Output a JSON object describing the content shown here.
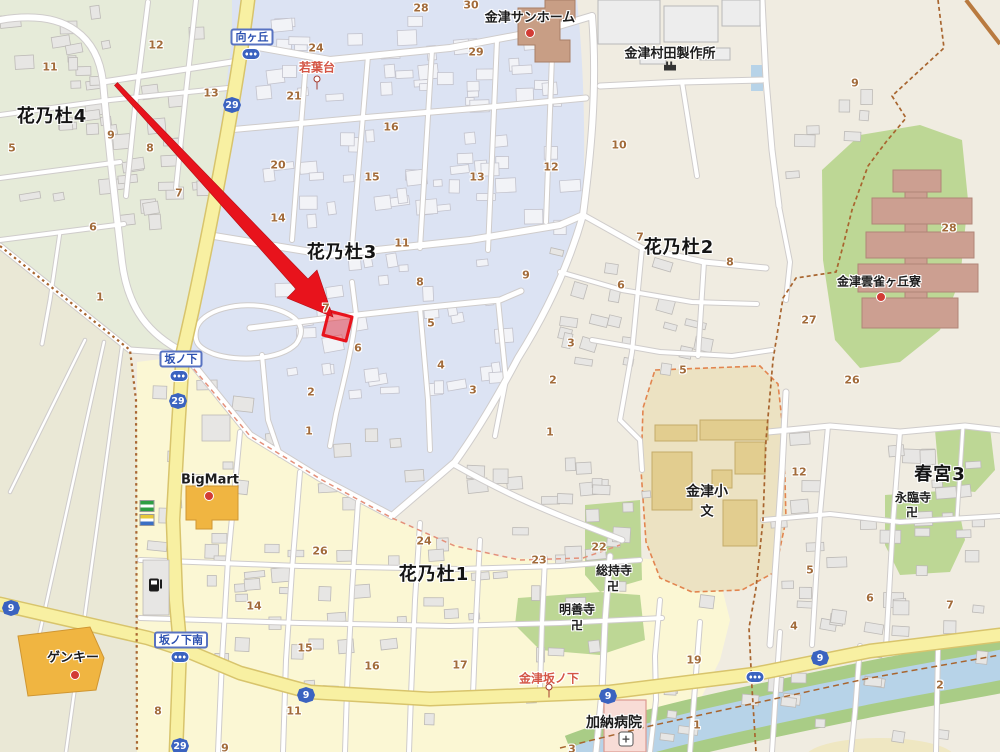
{
  "palette": {
    "base": "#f0ece1",
    "region_green": "#e6ebd9",
    "region_field": "#eae8d6",
    "region_blue": "#dce3f3",
    "region_yellow": "#fbf7d4",
    "green_patch": "#bdd795",
    "school_ground": "#ece2c2",
    "school_building": "#e2cd8f",
    "dorm_building": "#cc9f91",
    "special_brown": "#c89e85",
    "river": "#b7d3e8",
    "river_bank": "#a9cc86",
    "road_yellow": "#f8f0a2",
    "road_yellow_edge": "#d8c46c",
    "road_edge": "#cfcccb",
    "building_grey": "#e7e6e4",
    "building_blue_area": "#f2f3f7",
    "store_orange": "#f0b541",
    "hospital_pink": "#f8dcd6",
    "boundary_brown": "#a8652f",
    "boundary_orange": "#e2854f",
    "highlight_red": "#e8131c",
    "shield_blue": "#3b63c0",
    "number_brown": "#a26b3a",
    "poi_orange": "#d45545",
    "bus_blue": "#2b50b0"
  },
  "districts": [
    {
      "text": "花乃杜4",
      "x": 52,
      "y": 115
    },
    {
      "text": "花乃杜3",
      "x": 342,
      "y": 251
    },
    {
      "text": "花乃杜2",
      "x": 679,
      "y": 246
    },
    {
      "text": "花乃杜1",
      "x": 434,
      "y": 573
    },
    {
      "text": "春宮3",
      "x": 940,
      "y": 473
    }
  ],
  "places": [
    {
      "text": "金津サンホーム",
      "x": 530,
      "y": 16,
      "size": 13,
      "bold": true
    },
    {
      "text": "金津村田製作所",
      "x": 670,
      "y": 52,
      "size": 13,
      "bold": true
    },
    {
      "text": "金津雲雀ヶ丘寮",
      "x": 879,
      "y": 281,
      "size": 12,
      "bold": false
    },
    {
      "text": "金津小",
      "x": 707,
      "y": 491,
      "size": 14,
      "bold": true
    },
    {
      "text": "文",
      "x": 707,
      "y": 510,
      "size": 13,
      "bold": true
    },
    {
      "text": "総持寺",
      "x": 614,
      "y": 570,
      "size": 12,
      "bold": false
    },
    {
      "text": "卍",
      "x": 613,
      "y": 586,
      "size": 12,
      "bold": false
    },
    {
      "text": "明善寺",
      "x": 577,
      "y": 609,
      "size": 12,
      "bold": false
    },
    {
      "text": "卍",
      "x": 577,
      "y": 625,
      "size": 12,
      "bold": false
    },
    {
      "text": "永臨寺",
      "x": 913,
      "y": 497,
      "size": 12,
      "bold": false
    },
    {
      "text": "卍",
      "x": 912,
      "y": 512,
      "size": 12,
      "bold": false
    },
    {
      "text": "加納病院",
      "x": 614,
      "y": 722,
      "size": 14,
      "bold": true
    },
    {
      "text": "BigMart",
      "x": 210,
      "y": 480,
      "size": 13,
      "bold": false
    },
    {
      "text": "ゲンキー",
      "x": 73,
      "y": 656,
      "size": 13,
      "bold": false
    }
  ],
  "orange_pois": [
    {
      "text": "若葉台",
      "x": 317,
      "y": 67
    },
    {
      "text": "金津坂ノ下",
      "x": 549,
      "y": 678
    }
  ],
  "bus_stops": [
    {
      "text": "向ヶ丘",
      "x": 252,
      "y": 37,
      "icon_x": 251,
      "icon_y": 54
    },
    {
      "text": "坂ノ下",
      "x": 181,
      "y": 359,
      "icon_x": 179,
      "icon_y": 376
    },
    {
      "text": "坂ノ下南",
      "x": 181,
      "y": 640,
      "icon_x": 180,
      "icon_y": 657
    }
  ],
  "lone_bus_icons": [
    {
      "x": 755,
      "y": 677
    }
  ],
  "pins": [
    {
      "x": 317,
      "y": 83
    },
    {
      "x": 549,
      "y": 691
    }
  ],
  "red_dots": [
    {
      "x": 530,
      "y": 33
    },
    {
      "x": 881,
      "y": 297
    },
    {
      "x": 209,
      "y": 496
    },
    {
      "x": 75,
      "y": 675
    }
  ],
  "road_shields": [
    {
      "num": "29",
      "x": 232,
      "y": 105
    },
    {
      "num": "29",
      "x": 178,
      "y": 401
    },
    {
      "num": "29",
      "x": 180,
      "y": 746
    },
    {
      "num": "9",
      "x": 11,
      "y": 608
    },
    {
      "num": "9",
      "x": 306,
      "y": 695
    },
    {
      "num": "9",
      "x": 608,
      "y": 696
    },
    {
      "num": "9",
      "x": 820,
      "y": 658
    }
  ],
  "icons": [
    {
      "name": "factory-icon",
      "x": 670,
      "y": 66
    },
    {
      "name": "hospital-icon",
      "x": 626,
      "y": 739,
      "glyph": "+"
    },
    {
      "name": "gas-station-icon",
      "x": 154,
      "y": 585
    },
    {
      "name": "convenience-store-icon-green",
      "x": 147,
      "y": 506
    },
    {
      "name": "convenience-store-icon-blue",
      "x": 147,
      "y": 520
    }
  ],
  "lot_numbers": [
    {
      "n": "11",
      "x": 50,
      "y": 67
    },
    {
      "n": "12",
      "x": 156,
      "y": 45
    },
    {
      "n": "13",
      "x": 211,
      "y": 93
    },
    {
      "n": "9",
      "x": 111,
      "y": 135
    },
    {
      "n": "8",
      "x": 150,
      "y": 148
    },
    {
      "n": "5",
      "x": 12,
      "y": 148
    },
    {
      "n": "7",
      "x": 179,
      "y": 193
    },
    {
      "n": "6",
      "x": 93,
      "y": 227
    },
    {
      "n": "1",
      "x": 100,
      "y": 297
    },
    {
      "n": "24",
      "x": 316,
      "y": 48
    },
    {
      "n": "21",
      "x": 294,
      "y": 96
    },
    {
      "n": "20",
      "x": 278,
      "y": 165
    },
    {
      "n": "14",
      "x": 278,
      "y": 218
    },
    {
      "n": "28",
      "x": 421,
      "y": 8
    },
    {
      "n": "30",
      "x": 471,
      "y": 5
    },
    {
      "n": "29",
      "x": 476,
      "y": 52
    },
    {
      "n": "16",
      "x": 391,
      "y": 127
    },
    {
      "n": "15",
      "x": 372,
      "y": 177
    },
    {
      "n": "13",
      "x": 477,
      "y": 177
    },
    {
      "n": "12",
      "x": 551,
      "y": 167
    },
    {
      "n": "11",
      "x": 402,
      "y": 243
    },
    {
      "n": "10",
      "x": 619,
      "y": 145
    },
    {
      "n": "9",
      "x": 855,
      "y": 83
    },
    {
      "n": "8",
      "x": 420,
      "y": 282
    },
    {
      "n": "7",
      "x": 326,
      "y": 308
    },
    {
      "n": "5",
      "x": 431,
      "y": 323
    },
    {
      "n": "6",
      "x": 358,
      "y": 348
    },
    {
      "n": "4",
      "x": 441,
      "y": 365
    },
    {
      "n": "3",
      "x": 473,
      "y": 390
    },
    {
      "n": "2",
      "x": 311,
      "y": 392
    },
    {
      "n": "1",
      "x": 309,
      "y": 431
    },
    {
      "n": "9",
      "x": 526,
      "y": 275
    },
    {
      "n": "7",
      "x": 640,
      "y": 237
    },
    {
      "n": "8",
      "x": 730,
      "y": 262
    },
    {
      "n": "6",
      "x": 621,
      "y": 285
    },
    {
      "n": "5",
      "x": 683,
      "y": 370
    },
    {
      "n": "3",
      "x": 571,
      "y": 343
    },
    {
      "n": "2",
      "x": 553,
      "y": 380
    },
    {
      "n": "1",
      "x": 550,
      "y": 432
    },
    {
      "n": "28",
      "x": 949,
      "y": 228
    },
    {
      "n": "27",
      "x": 809,
      "y": 320
    },
    {
      "n": "26",
      "x": 852,
      "y": 380
    },
    {
      "n": "12",
      "x": 799,
      "y": 472
    },
    {
      "n": "5",
      "x": 810,
      "y": 570
    },
    {
      "n": "6",
      "x": 870,
      "y": 598
    },
    {
      "n": "7",
      "x": 950,
      "y": 605
    },
    {
      "n": "4",
      "x": 794,
      "y": 626
    },
    {
      "n": "2",
      "x": 940,
      "y": 685
    },
    {
      "n": "22",
      "x": 599,
      "y": 547
    },
    {
      "n": "23",
      "x": 539,
      "y": 560
    },
    {
      "n": "26",
      "x": 320,
      "y": 551
    },
    {
      "n": "24",
      "x": 424,
      "y": 541
    },
    {
      "n": "15",
      "x": 305,
      "y": 648
    },
    {
      "n": "16",
      "x": 372,
      "y": 666
    },
    {
      "n": "17",
      "x": 460,
      "y": 665
    },
    {
      "n": "14",
      "x": 254,
      "y": 606
    },
    {
      "n": "8",
      "x": 158,
      "y": 711
    },
    {
      "n": "11",
      "x": 294,
      "y": 711
    },
    {
      "n": "9",
      "x": 225,
      "y": 748
    },
    {
      "n": "19",
      "x": 694,
      "y": 660
    },
    {
      "n": "1",
      "x": 697,
      "y": 725
    },
    {
      "n": "3",
      "x": 572,
      "y": 749
    }
  ],
  "highlight": {
    "parcel_center": {
      "x": 337,
      "y": 326
    },
    "arrow_from": {
      "x": 116,
      "y": 84
    },
    "arrow_to": {
      "x": 333,
      "y": 317
    }
  }
}
